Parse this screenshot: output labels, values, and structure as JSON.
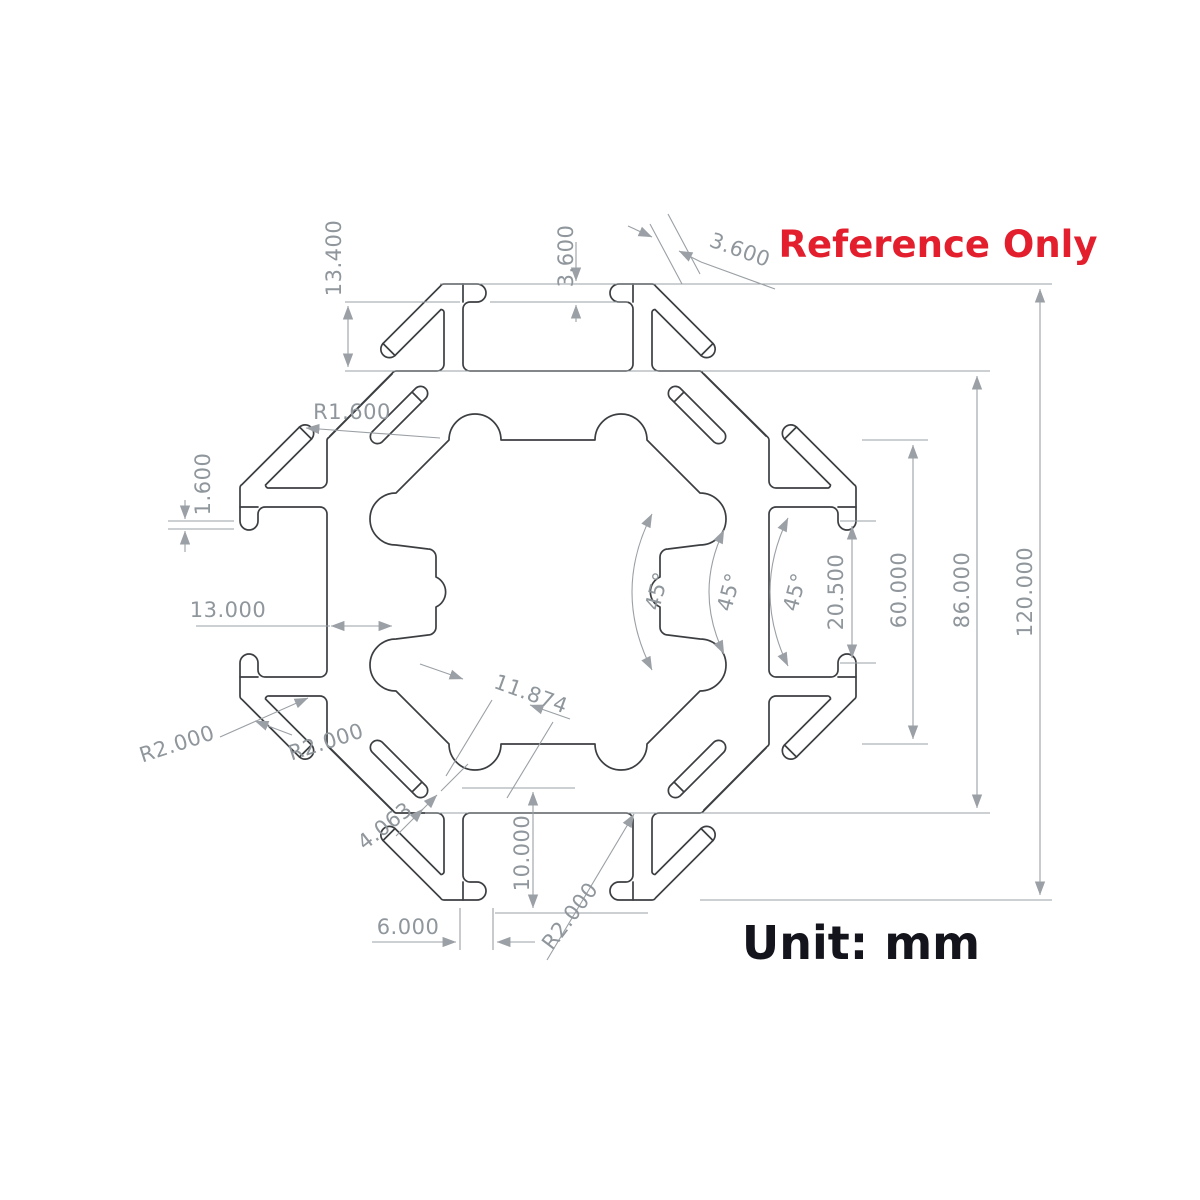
{
  "drawing": {
    "watermark": "Reference Only",
    "unit_note": "Unit: mm",
    "colors": {
      "watermark_red": "#e31e2d",
      "outline_gray": "#3c3f42",
      "dimension_gray": "#9aa0a5",
      "unit_text_black": "#14141c"
    },
    "dimensions": {
      "wing_height": "13.400",
      "lip_thickness": "3.600",
      "slot_mouth": "3.600",
      "corner_radius": "R1.600",
      "lip_step": "1.600",
      "web_thickness": "13.000",
      "angle_a": "45°",
      "angle_b": "45°",
      "angle_c": "45°",
      "slot_span": "20.500",
      "across_tabs": "60.000",
      "across_flats": "86.000",
      "overall_size": "120.000",
      "diagonal_width": "11.874",
      "radius_left": "R2.000",
      "radius_mid": "R2.000",
      "hook_slot": "4.063",
      "floor_depth": "10.000",
      "lip_width": "6.000",
      "radius_bottom": "R2.000"
    }
  }
}
